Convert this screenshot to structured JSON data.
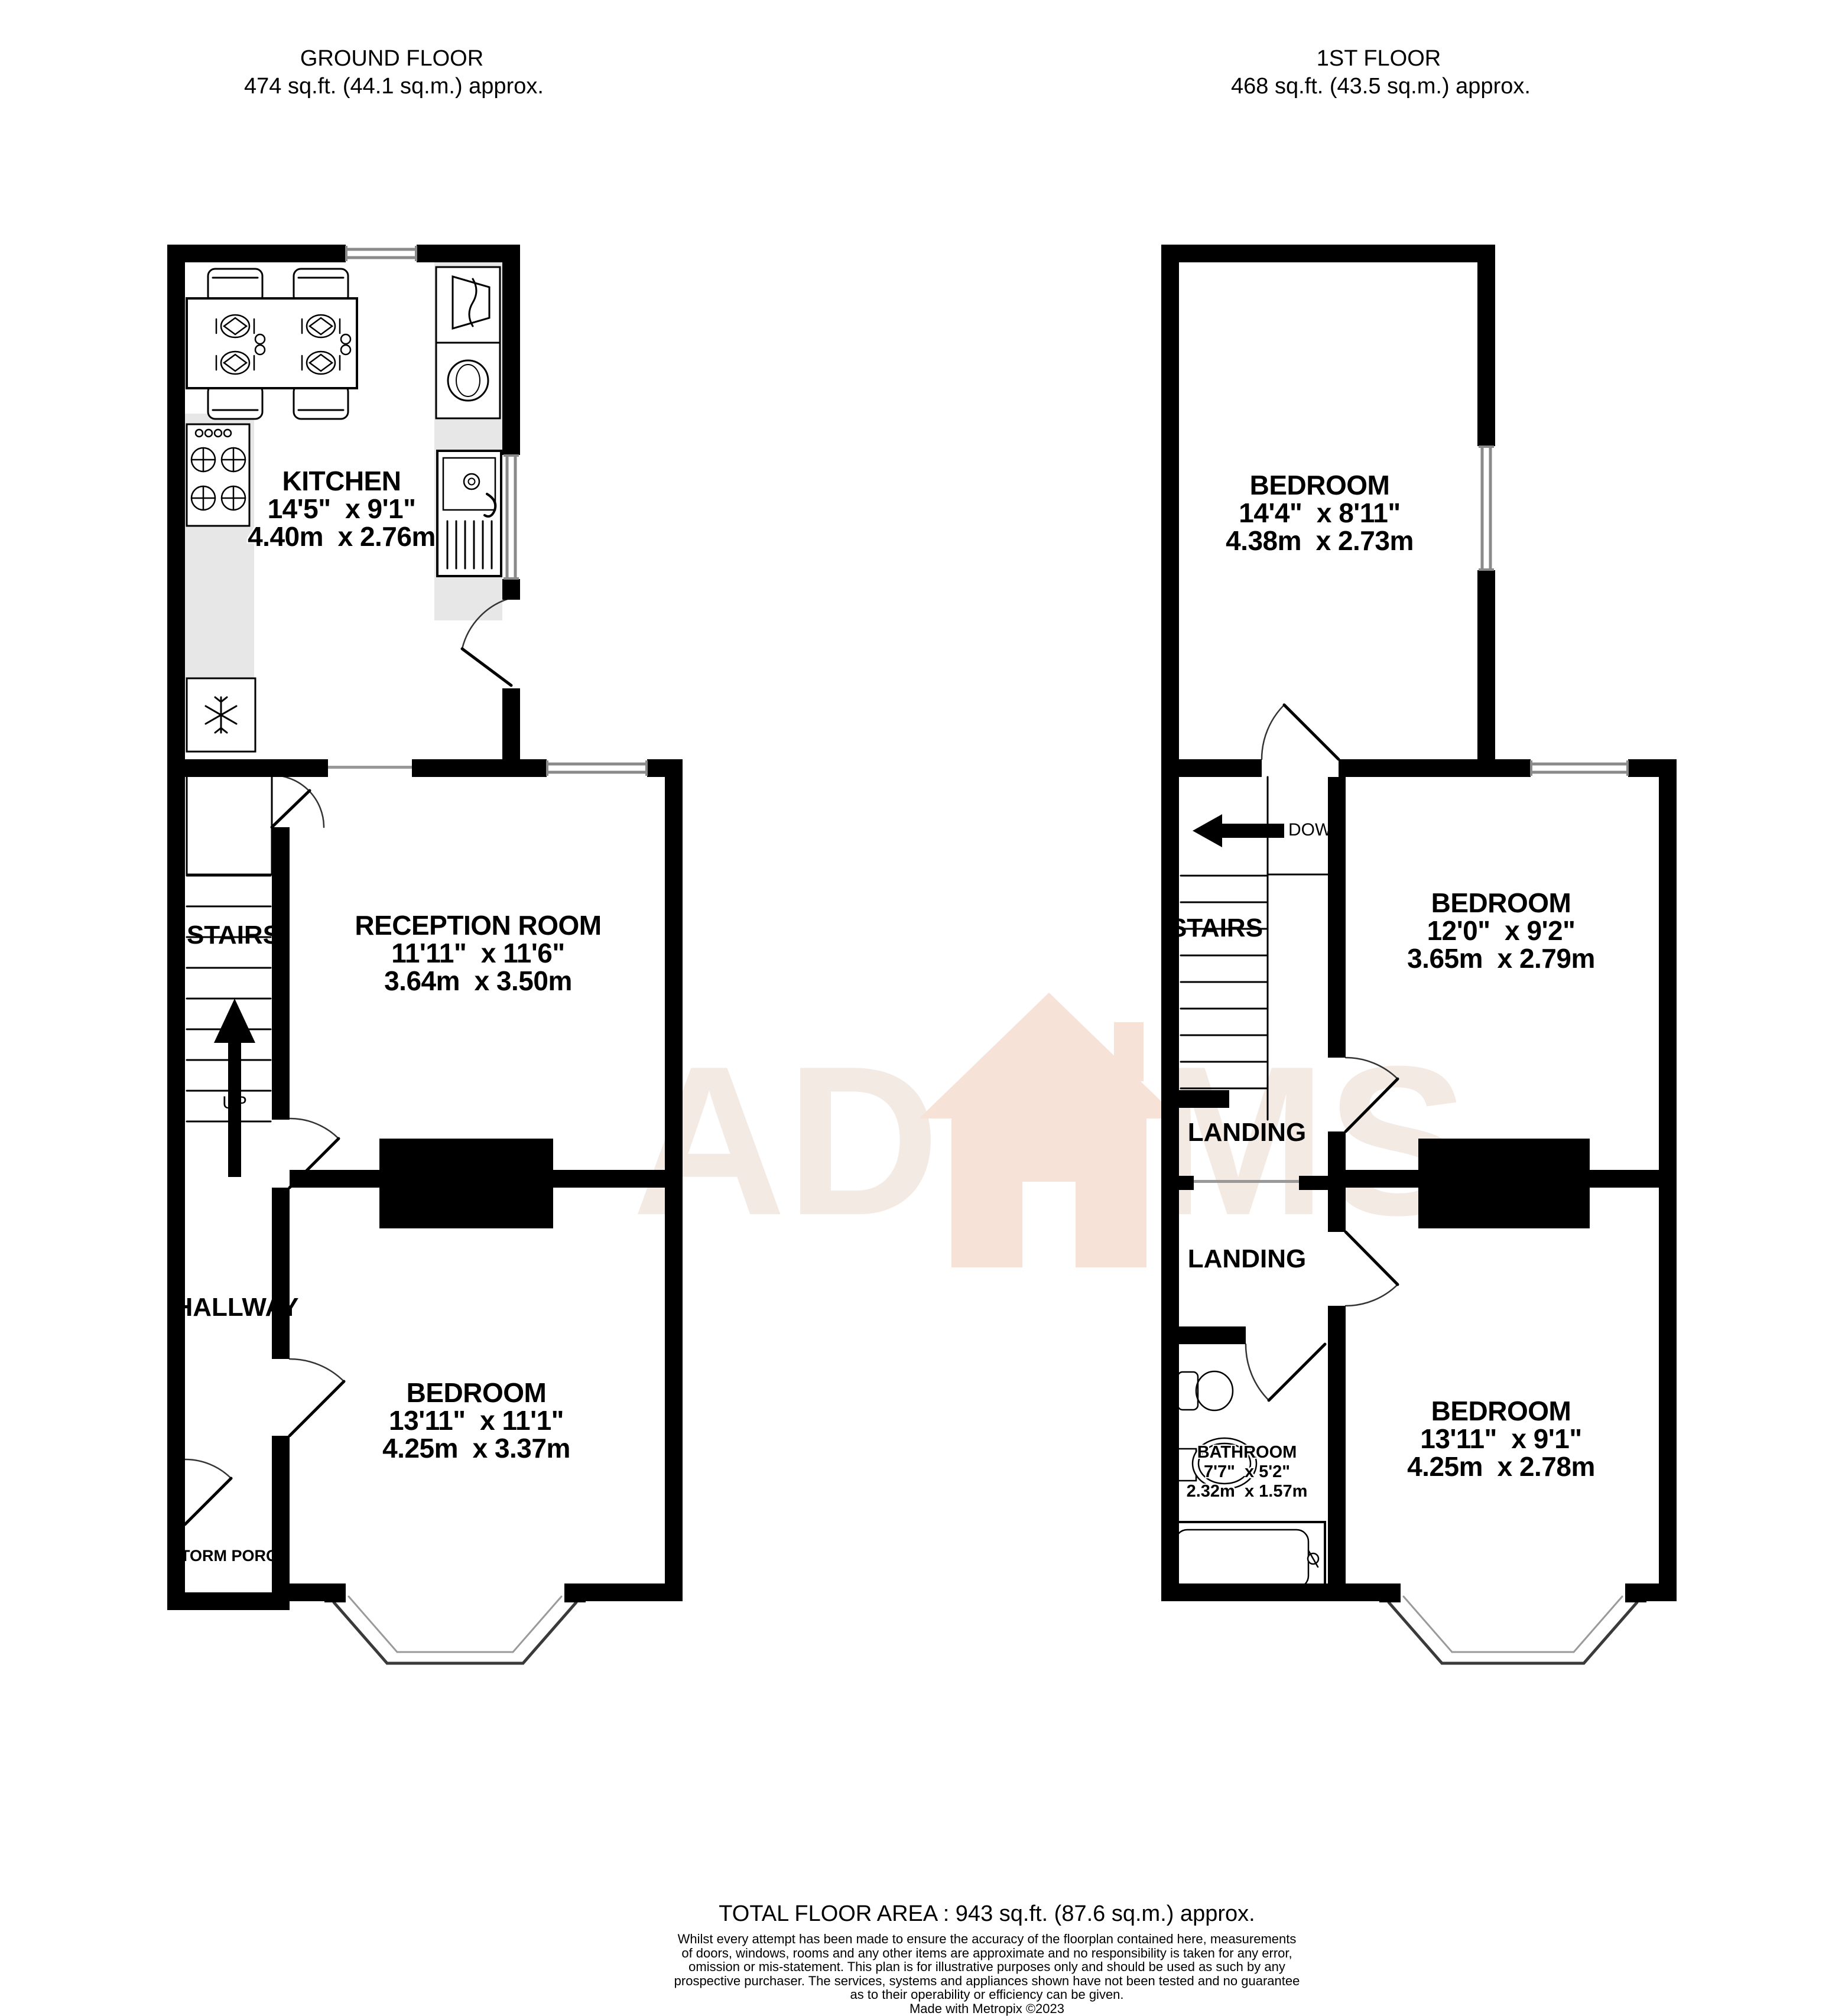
{
  "ground_floor": {
    "header": {
      "title": "GROUND FLOOR",
      "area": "474 sq.ft. (44.1 sq.m.) approx."
    },
    "rooms": {
      "kitchen": {
        "name": "KITCHEN",
        "imperial": "14'5\"  x 9'1\"",
        "metric": "4.40m  x 2.76m"
      },
      "reception": {
        "name": "RECEPTION ROOM",
        "imperial": "11'11\"  x 11'6\"",
        "metric": "3.64m  x 3.50m"
      },
      "bedroom": {
        "name": "BEDROOM",
        "imperial": "13'11\"  x 11'1\"",
        "metric": "4.25m  x 3.37m"
      }
    },
    "stairs_label": "STAIRS",
    "up_label": "UP",
    "hallway_label": "HALLWAY",
    "storm_porch_label": "STORM PORCH"
  },
  "first_floor": {
    "header": {
      "title": "1ST FLOOR",
      "area": "468 sq.ft. (43.5 sq.m.) approx."
    },
    "rooms": {
      "bedroom_rear": {
        "name": "BEDROOM",
        "imperial": "14'4\"  x 8'11\"",
        "metric": "4.38m  x 2.73m"
      },
      "bedroom_middle": {
        "name": "BEDROOM",
        "imperial": "12'0\"  x 9'2\"",
        "metric": "3.65m  x 2.79m"
      },
      "bedroom_front": {
        "name": "BEDROOM",
        "imperial": "13'11\"  x 9'1\"",
        "metric": "4.25m  x 2.78m"
      },
      "bathroom": {
        "name": "BATHROOM",
        "imperial": "7'7\"  x 5'2\"",
        "metric": "2.32m  x 1.57m"
      }
    },
    "stairs_label": "STAIRS",
    "down_label": "DOWN",
    "landing_rear_label": "LANDING",
    "landing_front_label": "LANDING"
  },
  "footer": {
    "total": "TOTAL FLOOR AREA : 943 sq.ft. (87.6 sq.m.) approx.",
    "disclaimer_lines": [
      "Whilst every attempt has been made to ensure the accuracy of the floorplan contained here, measurements",
      "of doors, windows, rooms and any other items are approximate and no responsibility is taken for any error,",
      "omission or mis-statement. This plan is for illustrative purposes only and should be used as such by any",
      "prospective purchaser. The services, systems and appliances shown have not been tested and no guarantee",
      "as to their operability or efficiency can be given."
    ],
    "credit": "Made with Metropix ©2023"
  },
  "watermark": {
    "left": "AD",
    "right": "MS"
  },
  "colors": {
    "wall": "#000000",
    "counter": "#e7e7e7",
    "window_line": "#8a8a8a",
    "watermark_text": "#f4eae4",
    "watermark_house": "#f6e2d6"
  }
}
